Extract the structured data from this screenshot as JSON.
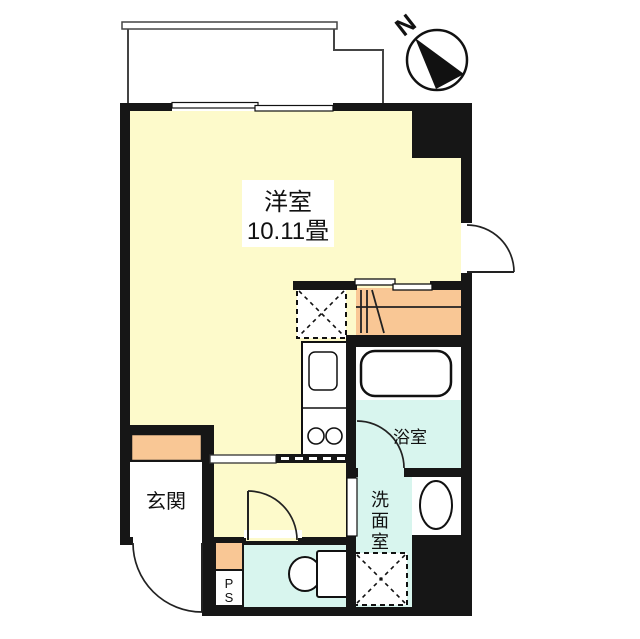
{
  "plan_title": "ワンルーム間取り図",
  "compass": {
    "label": "N"
  },
  "rooms": {
    "living": {
      "name": "洋室",
      "size": "10.11畳"
    },
    "entrance": {
      "label": "玄関"
    },
    "bathroom": {
      "label": "浴室"
    },
    "washroom": {
      "label": "洗面室"
    },
    "pipe_space": {
      "label": "PS"
    }
  },
  "fixtures": [
    "bathtub",
    "toilet",
    "wash-basin",
    "kitchen-sink",
    "stove-burners",
    "refrigerator-space",
    "washing-machine-space",
    "balcony"
  ],
  "colors": {
    "floor_yellow": "#FDFACB",
    "accent_orange": "#F9C795",
    "wet_area_cyan": "#D8F5EE",
    "wall_black": "#161616"
  }
}
